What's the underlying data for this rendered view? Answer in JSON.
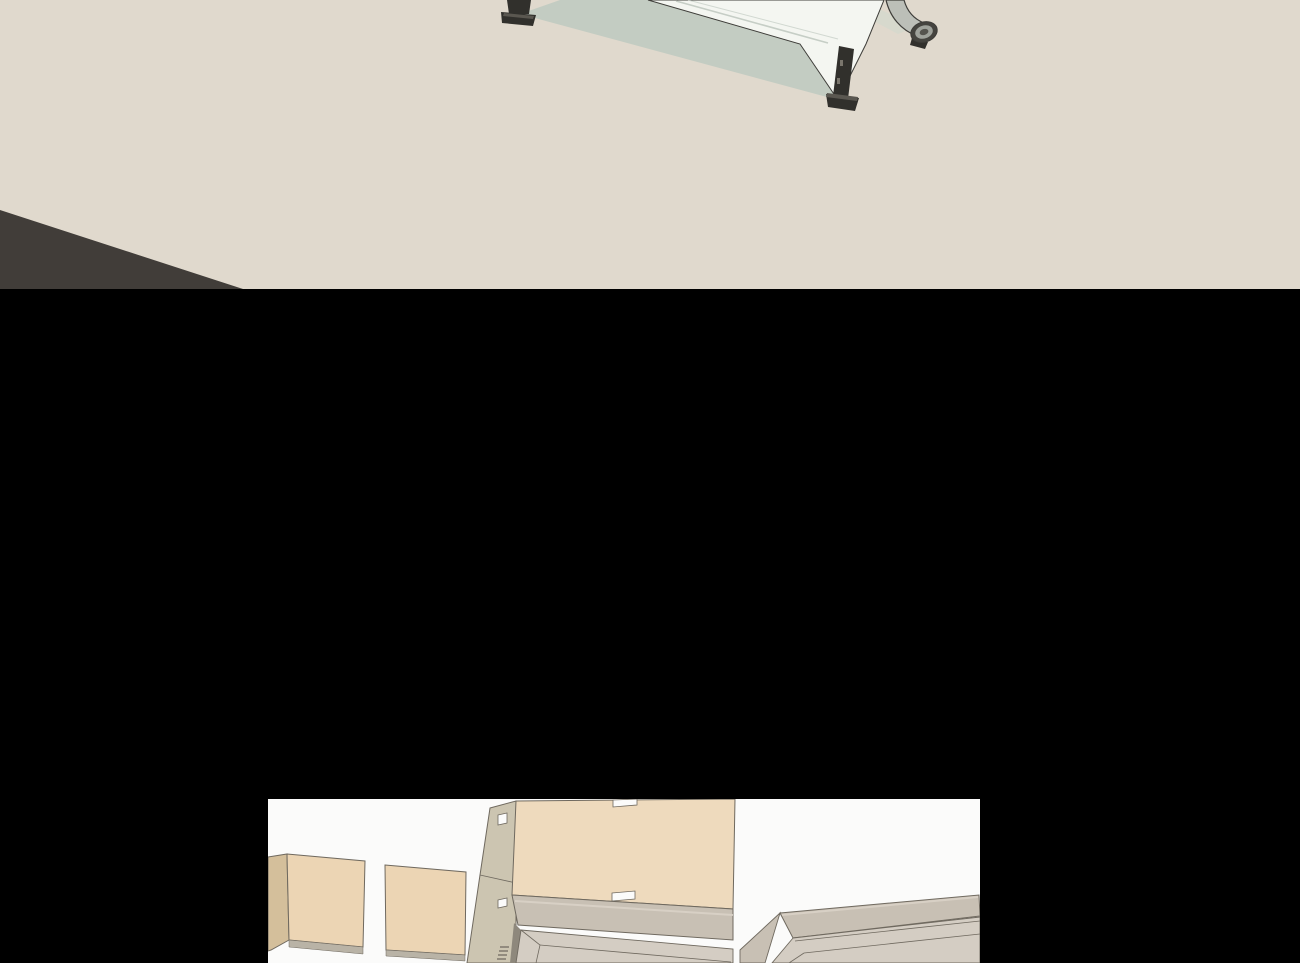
{
  "page": {
    "type": "webtoon-comic-page",
    "width_px": 1300,
    "height_px": 963,
    "text_content": "none",
    "description": "Vertical comic page on a black background with two borderless SketchUp-style rendered art panels and no text"
  },
  "panels": {
    "top": {
      "id": "panel-1",
      "description": "Beige room scene cropped by the page top: white-topped office desk with dark metal legs casting a sage-green shadow, an office-chair armrest entering from the right, and a dark gray floor wedge in the lower-left corner",
      "objects": {
        "floor": "beige floor",
        "shadow_wedge": "dark floor wedge, lower-left",
        "desk_shadow": "sage-green shadow under desk",
        "desk_top": "white desk top seen edge-on",
        "desk_leg_left": "dark metal desk leg with foot, upper-left",
        "desk_leg_right": "dark metal desk leg with foot and adjustment holes",
        "chair_armrest": "gray office-chair armrest with dark end cap"
      }
    },
    "bottom": {
      "id": "panel-2",
      "description": "White interior scene viewed from above: two tan wardrobe door panels at left, a large tan wardrobe body with small white handle notches in the center, and gray beveled cabinet tops at center and right",
      "objects": {
        "wardrobe_door_left": "tan door panel",
        "wardrobe_door_right": "tan door panel",
        "wardrobe_side": "dark tan side sliver at panel edge",
        "cabinet_left_face": "olive-gray cabinet side face with handle notches",
        "wardrobe_front": "large tan wardrobe front with handle notches",
        "counter_center": "gray counter top band",
        "cabinet_door_center": "beveled gray cabinet door",
        "hinge_spring": "small spring/hinge detail",
        "cabinet_right": "gray cabinet with beveled top rising to the right"
      }
    }
  },
  "colors": {
    "black": "#000000",
    "beige": "#e0d9cd",
    "wedge": "#413d39",
    "sage": "#c3ccc2",
    "sageLight": "#d7d9cd",
    "deskTop": "#f4f6f1",
    "seam": "#c6cec6",
    "outlineDark": "#3e3d39",
    "legDark": "#31302c",
    "legMid": "#5a5750",
    "legHole": "#7a766d",
    "armTube": "#bcbfb8",
    "armCapDark": "#45443f",
    "armCapMid": "#9fa29b",
    "armCapCore": "#55544e",
    "panelBg": "#fbfbfa",
    "outline": "#6f695f",
    "tanDoor": "#ecd5b4",
    "tanSide": "#d4bf9b",
    "tanFront": "#eedabd",
    "olive": "#ccc5b1",
    "strip": "#b9b3a6",
    "counter": "#c8c0b4",
    "counterHi": "#d9d2c6",
    "gapDark": "#8e887c",
    "door": "#d4cdc3"
  }
}
